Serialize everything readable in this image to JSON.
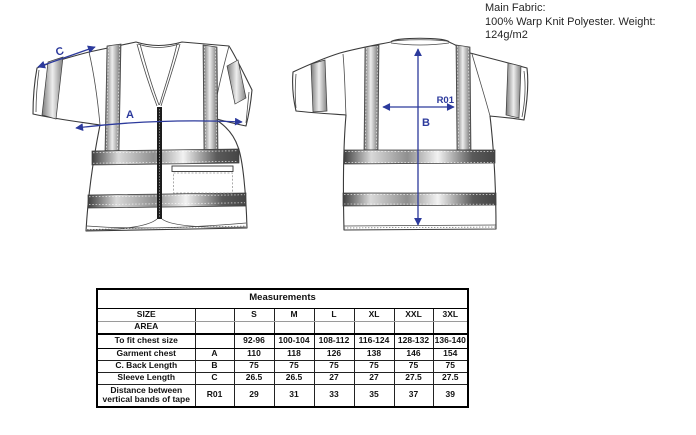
{
  "fabric_note": {
    "line1": "Main Fabric:",
    "line2": "100% Warp Knit Polyester. Weight: 124g/m2"
  },
  "diagram": {
    "front_view": {
      "chest_width_label": "A",
      "sleeve_length_label": "C"
    },
    "back_view": {
      "back_length_label": "B",
      "tape_distance_label": "R01"
    },
    "arrow_color": "#2c3a9c",
    "outline_color": "#3a3a3a"
  },
  "table": {
    "title": "Measurements",
    "row_header_line1": "SIZE",
    "row_header_line2": "AREA",
    "sizes": [
      "S",
      "M",
      "L",
      "XL",
      "XXL",
      "3XL"
    ],
    "rows": [
      {
        "label": "To fit chest size",
        "code": "",
        "values": [
          "92-96",
          "100-104",
          "108-112",
          "116-124",
          "128-132",
          "136-140"
        ]
      },
      {
        "label": "Garment chest",
        "code": "A",
        "values": [
          "110",
          "118",
          "126",
          "138",
          "146",
          "154"
        ]
      },
      {
        "label": "C. Back Length",
        "code": "B",
        "values": [
          "75",
          "75",
          "75",
          "75",
          "75",
          "75"
        ]
      },
      {
        "label": "Sleeve Length",
        "code": "C",
        "values": [
          "26.5",
          "26.5",
          "27",
          "27",
          "27.5",
          "27.5"
        ]
      },
      {
        "label": "Distance between vertical bands of tape",
        "code": "R01",
        "values": [
          "29",
          "31",
          "33",
          "35",
          "37",
          "39"
        ]
      }
    ]
  },
  "chart_data": {
    "type": "table",
    "title": "Measurements",
    "columns": [
      "SIZE AREA",
      "Code",
      "S",
      "M",
      "L",
      "XL",
      "XXL",
      "3XL"
    ],
    "rows": [
      [
        "To fit chest size",
        "",
        "92-96",
        "100-104",
        "108-112",
        "116-124",
        "128-132",
        "136-140"
      ],
      [
        "Garment chest",
        "A",
        110,
        118,
        126,
        138,
        146,
        154
      ],
      [
        "C. Back Length",
        "B",
        75,
        75,
        75,
        75,
        75,
        75
      ],
      [
        "Sleeve Length",
        "C",
        26.5,
        26.5,
        27,
        27,
        27.5,
        27.5
      ],
      [
        "Distance between vertical bands of tape",
        "R01",
        29,
        31,
        33,
        35,
        37,
        39
      ]
    ]
  }
}
